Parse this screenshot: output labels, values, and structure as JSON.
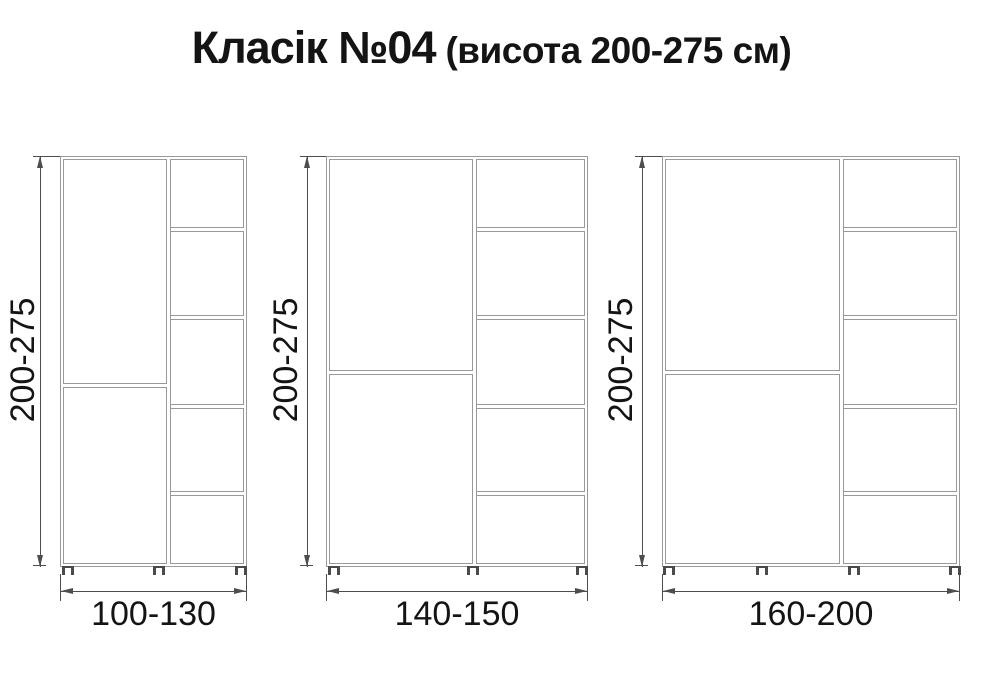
{
  "title": {
    "main": "Класік №04",
    "suffix": "(висота 200-275 см)"
  },
  "colors": {
    "background": "#ffffff",
    "cabinet_line": "#999999",
    "dimension_line": "#4d4d4d",
    "text": "#141414"
  },
  "cabinets": [
    {
      "name": "cabinet-small",
      "height_label": "200-275",
      "width_label": "100-130",
      "shelf_compartments": 5,
      "door_sections": 2,
      "feet": 3
    },
    {
      "name": "cabinet-medium",
      "height_label": "200-275",
      "width_label": "140-150",
      "shelf_compartments": 5,
      "door_sections": 2,
      "feet": 3
    },
    {
      "name": "cabinet-large",
      "height_label": "200-275",
      "width_label": "160-200",
      "shelf_compartments": 5,
      "door_sections": 2,
      "feet": 4
    }
  ]
}
